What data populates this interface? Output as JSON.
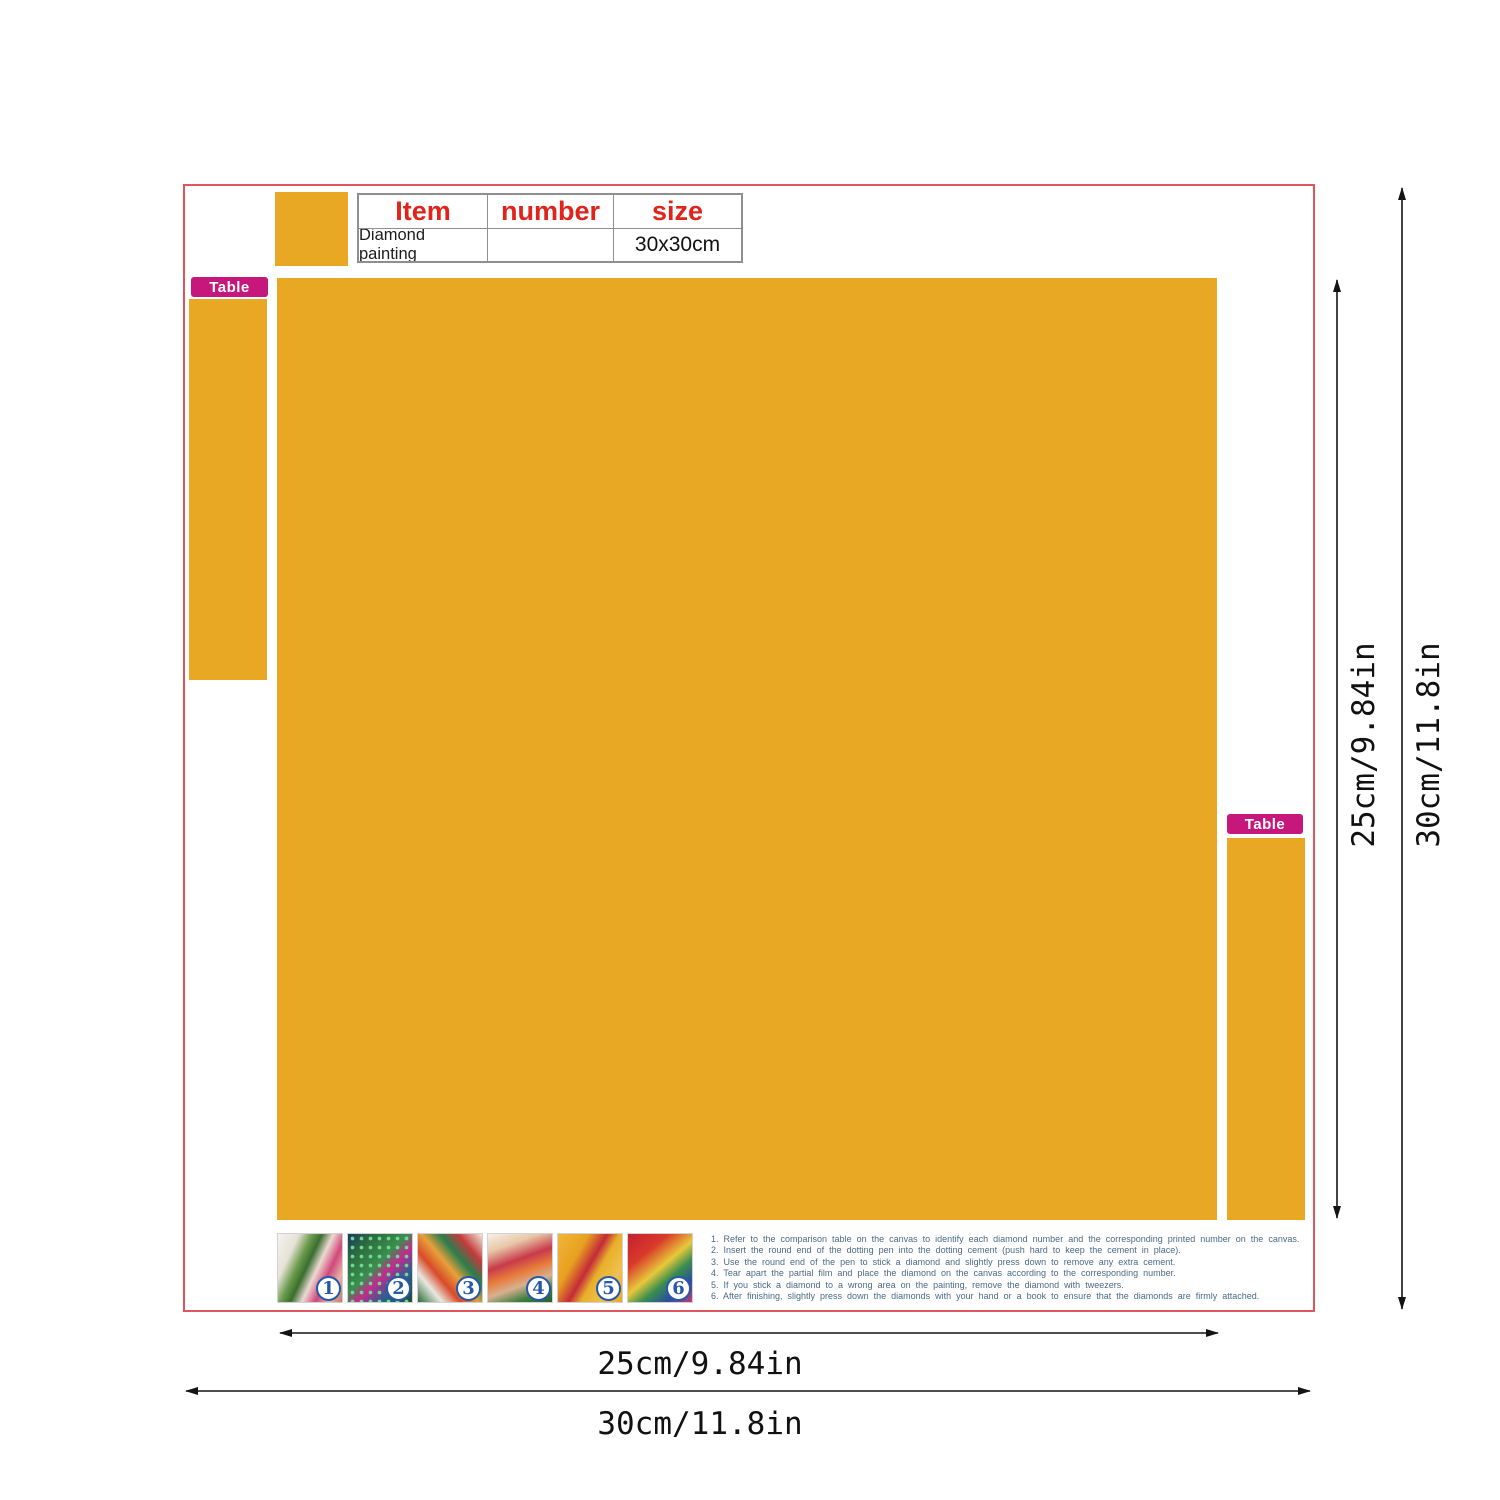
{
  "info_table": {
    "col_item": "Item",
    "col_number": "number",
    "col_size": "size",
    "item_value": "Diamond painting",
    "number_value": "",
    "size_value": "30x30cm"
  },
  "tags": {
    "table_left": "Table",
    "table_right": "Table"
  },
  "dimensions": {
    "inner_width": "25cm/9.84in",
    "outer_width": "30cm/11.8in",
    "inner_height": "25cm/9.84in",
    "outer_height": "30cm/11.8in"
  },
  "steps": {
    "numbers": [
      "1",
      "2",
      "3",
      "4",
      "5",
      "6"
    ],
    "instructions": [
      "1. Refer to the comparison table on the canvas to identify each diamond number and the corresponding printed number on the canvas.",
      "2. Insert the round end of the dotting pen into the dotting cement (push hard to keep the cement in place).",
      "3. Use the round end of the pen to stick a diamond and slightly press down to remove any extra cement.",
      "4. Tear apart the partial film and place the diamond on the canvas according to the corresponding number.",
      "5. If you stick a diamond to a wrong area on the painting, remove the diamond with tweezers.",
      "6. After finishing, slightly press down the diamonds with your hand or a book to ensure that the diamonds are firmly attached."
    ]
  },
  "colors": {
    "canvas_orange": "#E8A824",
    "tag_magenta": "#C5177C",
    "table_header_red": "#E0241B",
    "frame_red": "#E0545C",
    "instruction_blue": "#4A6A85",
    "step_badge_blue": "#2558A8"
  }
}
